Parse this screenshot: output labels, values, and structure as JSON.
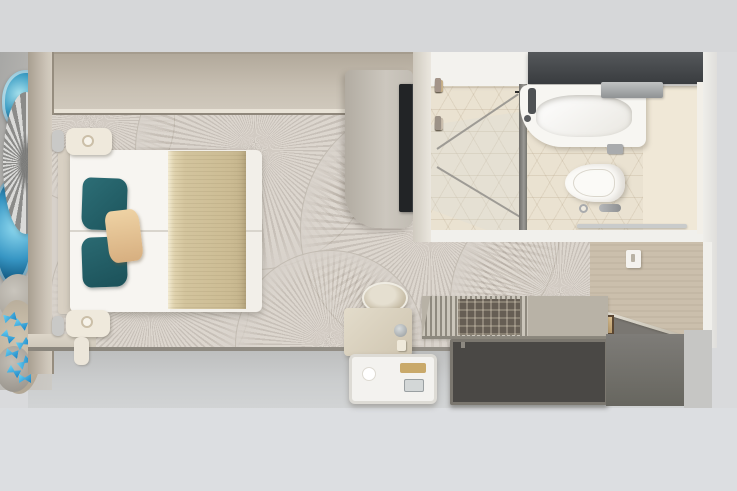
{
  "scene": {
    "title": "Cabin floor plan - top-down 3D render",
    "rooms": [
      "bedroom",
      "bathroom",
      "entry-corridor",
      "closet"
    ],
    "no_visible_text": true
  },
  "palette": {
    "background": "#d9dadc",
    "wall_beige": "#c4bbad",
    "carpet": "#d7d1ca",
    "bed_white": "#f2efe9",
    "pillow_teal": "#215e66",
    "pillow_tan": "#e2bf8e",
    "blanket_khaki": "#d3c49e",
    "tv_black": "#222426",
    "bath_cabinet_charcoal": "#45484b",
    "bath_floor_cream": "#eae2d1",
    "fixture_white": "#f8f7f4",
    "wardrobe_interior_dark": "#4a4845",
    "door_beige": "#cbbfac",
    "chrome": "#b9bcbe",
    "butterfly_blue": "#2ba3de",
    "agate_blue": "#2a8cb8"
  },
  "bedroom": {
    "bed": {
      "type": "double, two joined mattresses",
      "accent_pillows_teal": 2,
      "throw_pillow_tan": 1,
      "runner_blanket": "khaki"
    },
    "reading_lamps": 2,
    "tv": 1,
    "stool": 1,
    "desk_items": [
      "kettle",
      "bottle"
    ],
    "tray_items": [
      "gold box",
      "glass",
      "cup"
    ]
  },
  "bathroom": {
    "fixtures": [
      "shower",
      "sink counter",
      "toilet",
      "towel bar",
      "toilet paper holder",
      "flush valve",
      "floor drain"
    ],
    "toiletry_colors": [
      "#d9cfc0",
      "#b8b0a2",
      "#8e8678",
      "#ffffff",
      "#c8b18a",
      "#a4958a",
      "#7d7468",
      "#e8e2d6",
      "#b8ada0",
      "#90867c",
      "#cbbfae",
      "#9c9287"
    ]
  },
  "closet": {
    "compartments": [
      {
        "garment_colors": [
          "#8f3a4d",
          "#332e30"
        ]
      },
      {
        "garment_colors": [
          "#8f3a4d",
          "#3b3734",
          "#7e7a38"
        ]
      }
    ],
    "rail_color": "#d5d5d3"
  },
  "decor": {
    "left_wall_art": [
      "blue agate slice",
      "silver sunburst sculpture",
      "blue crystal",
      "pebbles",
      "sand"
    ],
    "butterflies": {
      "count": 8,
      "color_from": "#6ad2f5",
      "color_to": "#1b84c4"
    }
  }
}
